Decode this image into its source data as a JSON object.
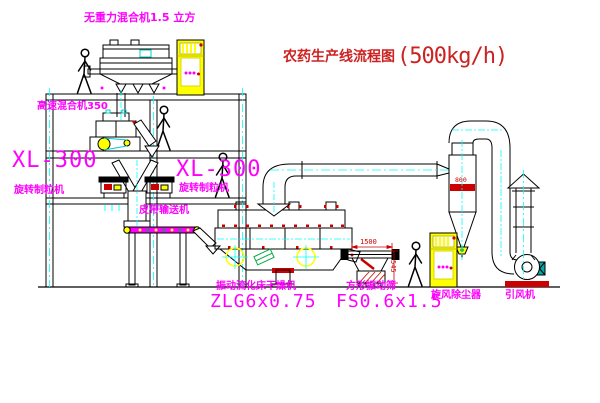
{
  "title": {
    "text": "农药生产线流程图",
    "capacity": "(500kg/h)"
  },
  "labels": {
    "gravity_mixer": "无重力混合机1.5 立方",
    "high_speed_mixer": "高速混合机350",
    "granulator_left_model": "XL-300",
    "granulator_left_name": "旋转制粒机",
    "granulator_mid_model": "XL-300",
    "granulator_mid_name": "旋转制粒机",
    "belt_conveyor": "皮带输送机",
    "dryer_name": "振动流化床干燥机",
    "dryer_model": "ZLG6x0.75",
    "sieve_name": "方形振动筛",
    "sieve_model": "FS0.6x1.5",
    "cyclone": "旋风除尘器",
    "fan": "引风机"
  },
  "dimensions": {
    "sieve_width": "1500",
    "sieve_height": "545",
    "cyclone_dia": "800"
  },
  "colors": {
    "label": "#ff00ff",
    "title": "#cc2222",
    "line": "#000000",
    "centerline": "#00ffff",
    "equipment_yellow": "#ffff00",
    "accent_red": "#cc0000",
    "accent_green": "#00aa44",
    "motor_teal": "#00aaaa"
  }
}
